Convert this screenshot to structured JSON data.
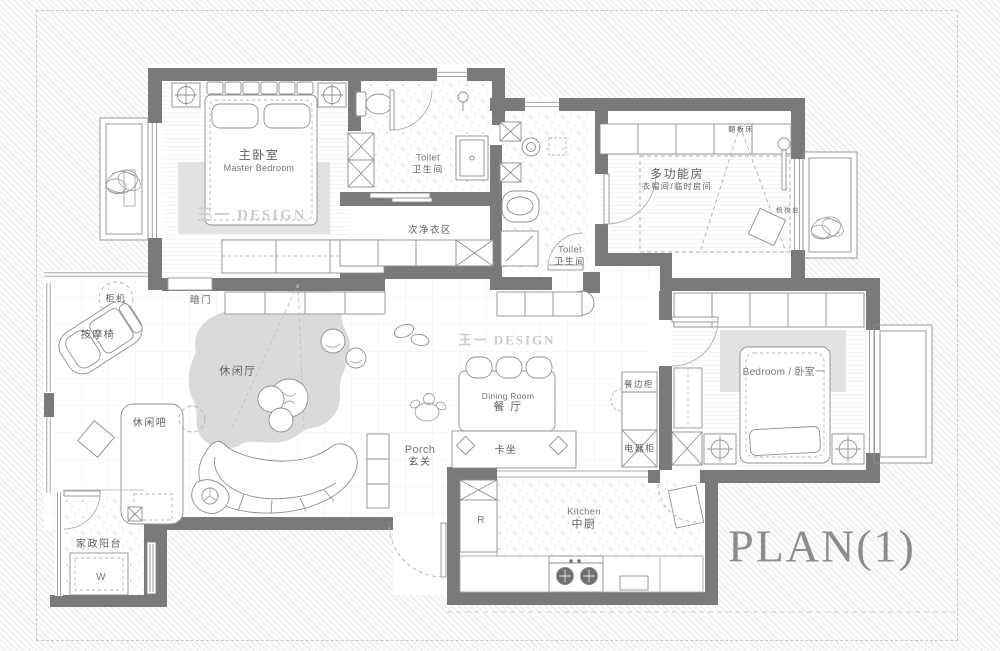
{
  "plan_title": "PLAN(1)",
  "watermark": "王一 DESIGN",
  "colors": {
    "wall": "#7a7a7a",
    "floor": "#ffffff",
    "carpet": "#e2e2e2",
    "rug": "#dadada",
    "label_text": "#5f5f5f",
    "watermark_text": "#cbcbcb",
    "title_text": "#8c8c8c",
    "furniture_line": "#8f8f8f"
  },
  "labels": {
    "master_bedroom": {
      "zh": "主卧室",
      "en": "Master Bedroom"
    },
    "master_toilet": {
      "en": "Toilet",
      "zh": "卫生间"
    },
    "closet_area": {
      "zh": "次净衣区"
    },
    "hidden_door": {
      "zh": "暗门"
    },
    "ac_unit": {
      "zh": "柜机"
    },
    "massage_chair": {
      "zh": "按摩椅"
    },
    "lounge": {
      "zh": "休闲厅"
    },
    "lounge_bar": {
      "zh": "休闲吧"
    },
    "service_balcony": {
      "zh": "家政阳台"
    },
    "washer": {
      "code": "W"
    },
    "hall_toilet": {
      "en": "Toilet",
      "zh": "卫生间"
    },
    "multi_function_room": {
      "zh": "多功能房",
      "sub": "衣帽间/临时房间"
    },
    "flip_bed": {
      "zh": "翻板床"
    },
    "dressing_table": {
      "zh": "梳妆台"
    },
    "bedroom_one": {
      "combo": "Bedroom / 卧室一"
    },
    "sideboard": {
      "zh": "餐边柜"
    },
    "appliance_cabinet": {
      "zh": "电器柜"
    },
    "dining_room": {
      "en": "Dining Room",
      "zh": "餐 厅"
    },
    "booth_seat": {
      "zh": "卡坐"
    },
    "porch": {
      "en": "Porch",
      "zh": "玄关"
    },
    "fridge": {
      "code": "R"
    },
    "kitchen": {
      "en": "Kitchen",
      "zh": "中厨"
    }
  }
}
